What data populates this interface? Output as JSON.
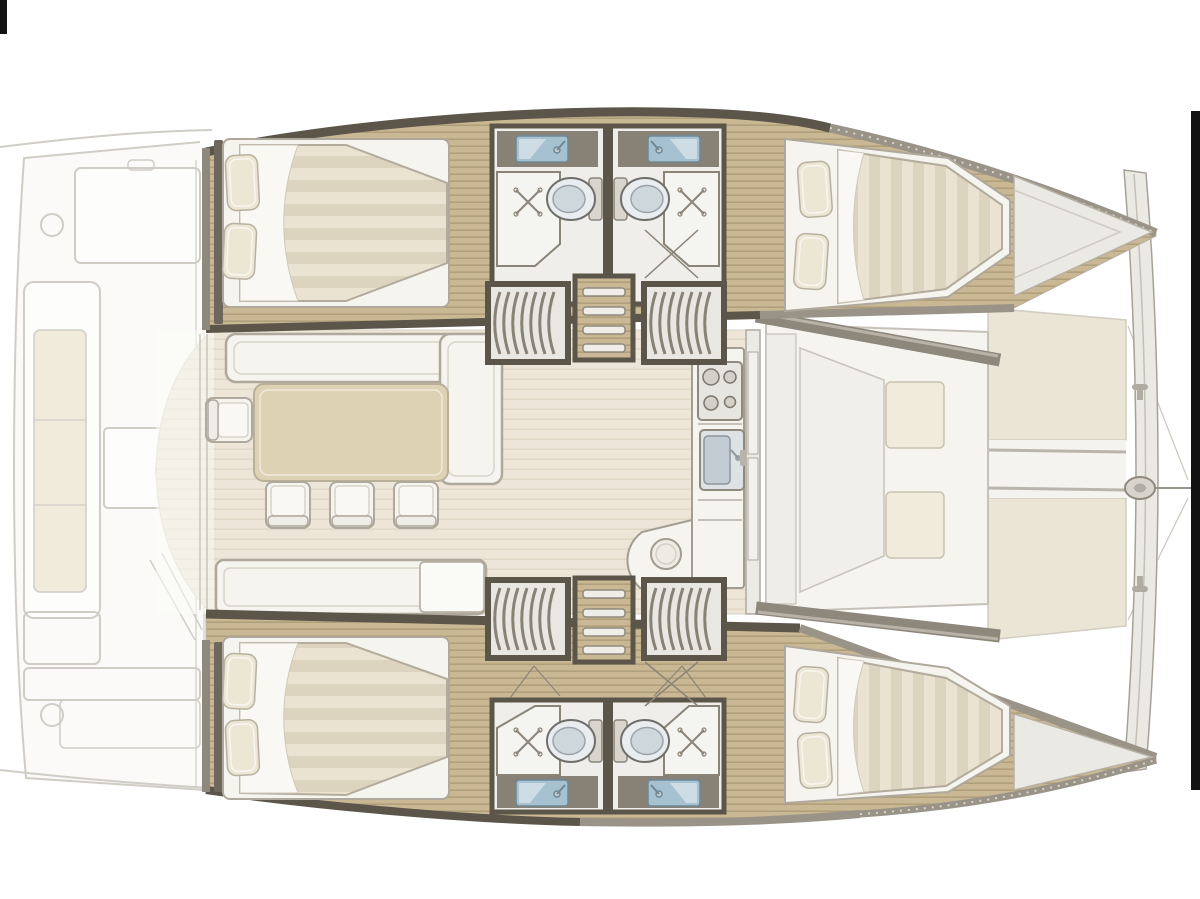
{
  "diagram": {
    "type": "boat-floorplan",
    "vessel": "catamaran",
    "view": "top-down interior deck plan, bow pointing right",
    "regions": {
      "aft_cockpit": "Aft cockpit (faded)",
      "saloon": "Saloon with dining table and galley",
      "port_hull": "Upper hull with two double cabins and two heads",
      "starboard_hull": "Lower hull with two double cabins and two heads",
      "foredeck": "Forward seating, trampolines and crossbeam"
    },
    "layout": {
      "hulls": 2,
      "cabins": [
        {
          "id": "upper-aft-cabin",
          "berth": "double",
          "pillows": 2
        },
        {
          "id": "upper-forward-cabin",
          "berth": "double",
          "pillows": 2
        },
        {
          "id": "lower-aft-cabin",
          "berth": "double",
          "pillows": 2
        },
        {
          "id": "lower-forward-cabin",
          "berth": "double",
          "pillows": 2
        }
      ],
      "heads": 4,
      "toilets": 4,
      "showers": 4,
      "washbasins": 4,
      "saloon": {
        "dining_chairs": 4,
        "sofas": 2,
        "table": 1,
        "galley": [
          "stove",
          "sink",
          "curved-counter",
          "stool"
        ]
      },
      "companionways": {
        "ladders": 2,
        "curved_stairs": 4
      },
      "foredeck": {
        "seating_cushions": 2,
        "trampolines": 2,
        "crossbeam": 1,
        "bowsprit_fitting": 1
      },
      "aft_cockpit": {
        "bench_cushion": 1,
        "table": 1
      }
    },
    "colors": {
      "background": "#ffffff",
      "border_black": "#121212",
      "faded_line": "#d0cdc6",
      "faded_fill": "#fbfaf8",
      "cushion": "#f0ebda",
      "wood_a": "#c9b893",
      "wood_b": "#b09f7b",
      "wall_dark": "#5b554a",
      "wall_mid": "#878176",
      "wall_gray": "#9a9388",
      "mat_a": "#eae3d2",
      "mat_b": "#ddd4c0",
      "sheet": "#f9f8f4",
      "pillow": "#ece6d5",
      "pillow_line": "#b8b0a0",
      "saloon_floor": "#ece5d8",
      "saloon_stripe": "#e1d9c8",
      "white_furn": "#f5f4ef",
      "furn_line": "#afa89c",
      "table": "#ddd2b4",
      "table_line": "#b9b09a",
      "counter_frame": "#878176",
      "sink_blue": "#a6c1cf",
      "sink_blue_dark": "#6e8795",
      "steel": "#d8d4cd",
      "toilet_white": "#e9edef",
      "toilet_seat": "#cdd7dc",
      "tramp": "#ebe5d6",
      "deck": "#ebe9e4",
      "deck_line": "#a8a197",
      "shower_line": "#8b8478"
    }
  }
}
